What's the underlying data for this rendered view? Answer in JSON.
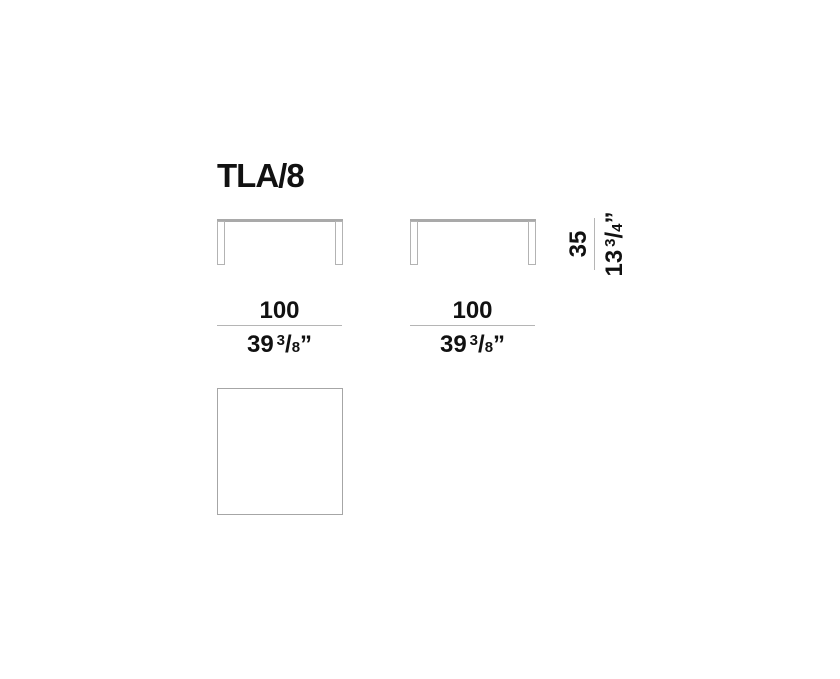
{
  "title": "TLA/8",
  "colors": {
    "ink": "#111111",
    "dim_line": "#b5b5b5",
    "tabletop": "#a9a9a9",
    "leg_outline": "#b3b3b3",
    "square_outline": "#a6a6a6"
  },
  "front_views": [
    {
      "width_dim": {
        "metric": "100",
        "imp_whole": "39",
        "imp_num": "3",
        "imp_slash": "/",
        "imp_den": "8",
        "imp_unit": "”"
      }
    },
    {
      "width_dim": {
        "metric": "100",
        "imp_whole": "39",
        "imp_num": "3",
        "imp_slash": "/",
        "imp_den": "8",
        "imp_unit": "”"
      }
    }
  ],
  "height_dim": {
    "metric": "35",
    "imp_whole": "13",
    "imp_num": "3",
    "imp_slash": "/",
    "imp_den": "4",
    "imp_unit": "”"
  }
}
